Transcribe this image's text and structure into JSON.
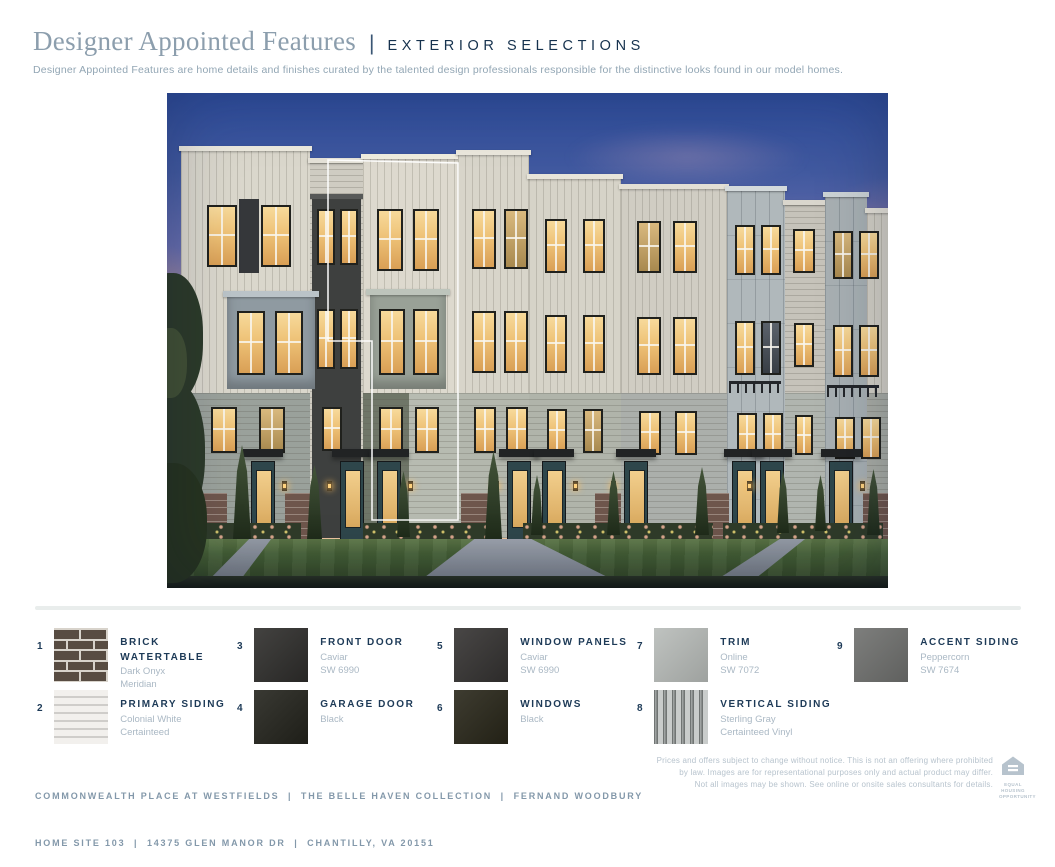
{
  "header": {
    "title": "Designer Appointed Features",
    "separator": "|",
    "subtitle_caps": "EXTERIOR SELECTIONS",
    "description": "Designer Appointed Features are home details and finishes curated by the talented design professionals responsible for the distinctive looks found in our model homes."
  },
  "hero": {
    "alt": "Dusk rendering of a row of four-story townhomes with warm lit windows, front lawns, walkways and landscaping; one home unit outlined in white",
    "palette": {
      "sky_top": "#2e4d9c",
      "sky_mid": "#6b6fae",
      "sky_violet": "#9483b4",
      "sky_rose": "#bb93af",
      "sky_horizon": "#dba795",
      "sky_low": "#ecc49e",
      "glow_left": "#f6aa5ad9",
      "glow_right": "#ec9a96cc",
      "siding_white": "#dad7cc",
      "siding_gray": "#9aa19b",
      "tower_gray": "#b0b8bb",
      "accent_charcoal": "#3e403f",
      "window_lit": "#eec277",
      "window_frame": "#20211d",
      "door_teal": "#2e464b",
      "canopy_black": "#212324",
      "brick_brown": "#6e564c",
      "lawn_green": "#456036",
      "walkway_gray": "#9aa0aa",
      "outline_white": "#ffffff"
    }
  },
  "selections": {
    "items": [
      {
        "number": "1",
        "name": "BRICK WATERTABLE",
        "details": [
          "Dark Onyx",
          "Meridian"
        ],
        "swatch": "brick"
      },
      {
        "number": "2",
        "name": "PRIMARY SIDING",
        "details": [
          "Colonial White",
          "Certainteed"
        ],
        "swatch": "siding-horizontal"
      },
      {
        "number": "3",
        "name": "FRONT DOOR",
        "details": [
          "Caviar",
          "SW 6990"
        ],
        "swatch": "solid",
        "color": "#2e2d2b"
      },
      {
        "number": "4",
        "name": "GARAGE DOOR",
        "details": [
          "Black"
        ],
        "swatch": "solid",
        "color": "#23231c"
      },
      {
        "number": "5",
        "name": "WINDOW PANELS",
        "details": [
          "Caviar",
          "SW 6990"
        ],
        "swatch": "solid",
        "color": "#343231"
      },
      {
        "number": "6",
        "name": "WINDOWS",
        "details": [
          "Black"
        ],
        "swatch": "solid",
        "color": "#282619"
      },
      {
        "number": "7",
        "name": "TRIM",
        "details": [
          "Online",
          "SW 7072"
        ],
        "swatch": "solid",
        "color": "#b8bcb9"
      },
      {
        "number": "8",
        "name": "VERTICAL SIDING",
        "details": [
          "Sterling Gray",
          "Certainteed Vinyl"
        ],
        "swatch": "siding-vertical"
      },
      {
        "number": "9",
        "name": "ACCENT SIDING",
        "details": [
          "Peppercorn",
          "SW 7674"
        ],
        "swatch": "solid",
        "color": "#6f706e"
      }
    ]
  },
  "footer": {
    "line1": "COMMONWEALTH PLACE AT WESTFIELDS  |  THE BELLE HAVEN COLLECTION  |  FERNAND WOODBURY",
    "line2": "HOME SITE 103  |  14375 GLEN MANOR DR  |  CHANTILLY, VA 20151",
    "disclaimer_lines": [
      "Prices and offers subject to change without notice. This is not an offering where prohibited",
      "by law. Images are for representational purposes only and actual product may differ.",
      "Not all images may be shown. See online or onsite sales consultants for details."
    ],
    "equal_housing": "EQUAL HOUSING OPPORTUNITY"
  }
}
